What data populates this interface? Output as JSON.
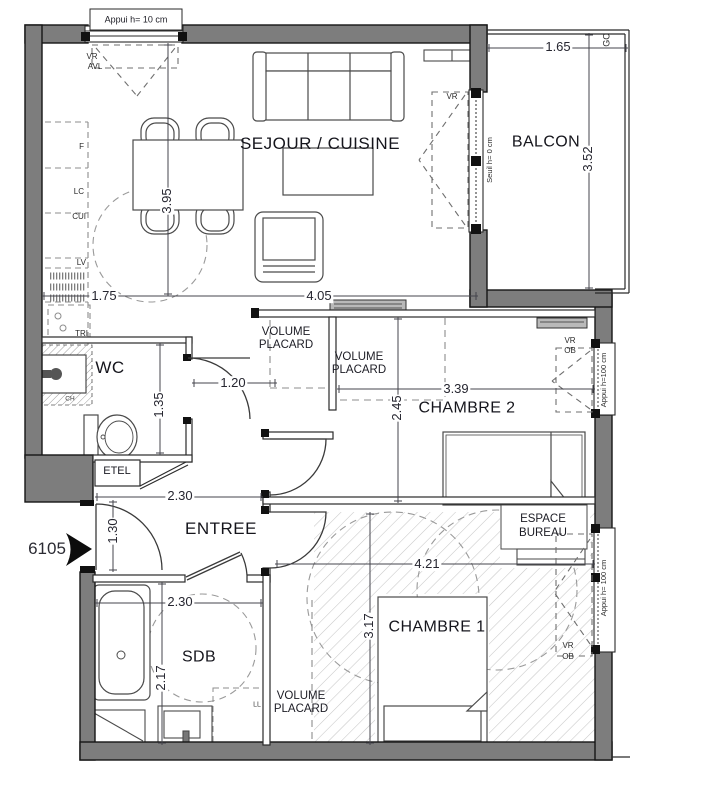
{
  "plan": {
    "unit_number": "6105",
    "rooms": {
      "sejour_cuisine": "SEJOUR / CUISINE",
      "balcon": "BALCON",
      "wc": "WC",
      "chambre2": "CHAMBRE 2",
      "entree": "ENTREE",
      "sdb": "SDB",
      "chambre1": "CHAMBRE 1"
    },
    "zones": {
      "volume_l1": "VOLUME",
      "volume_l2": "PLACARD",
      "bureau_l1": "ESPACE",
      "bureau_l2": "BUREAU",
      "etel": "ETEL"
    },
    "kitchen_labels": {
      "f": "F",
      "lc": "LC",
      "cui": "CUI",
      "lv": "LV",
      "tri": "TRI"
    },
    "annotations": {
      "sill_top_window": "Appui h= 10 cm",
      "threshold_balcony": "Seuil h= 0 cm",
      "sill_window_ch2": "Appui h=100 cm",
      "sill_window_ch1": "Appui h= 100 cm",
      "vr": "VR",
      "avl": "AVL",
      "ob": "OB",
      "gc": "GC",
      "ch": "CH",
      "ll": "LL"
    },
    "dimensions": {
      "sejour_height": "3.95",
      "kitchen_width": "1.75",
      "sejour_width": "4.05",
      "balcon_width": "1.65",
      "balcon_height": "3.52",
      "hall_width": "1.20",
      "wc_height": "1.35",
      "chambre2_width": "3.39",
      "chambre2_height": "2.45",
      "entree_width": "2.30",
      "entree_height": "1.30",
      "chambre1_width": "4.21",
      "sdb_width": "2.30",
      "sdb_height": "2.17",
      "chambre1_height": "3.17"
    }
  }
}
